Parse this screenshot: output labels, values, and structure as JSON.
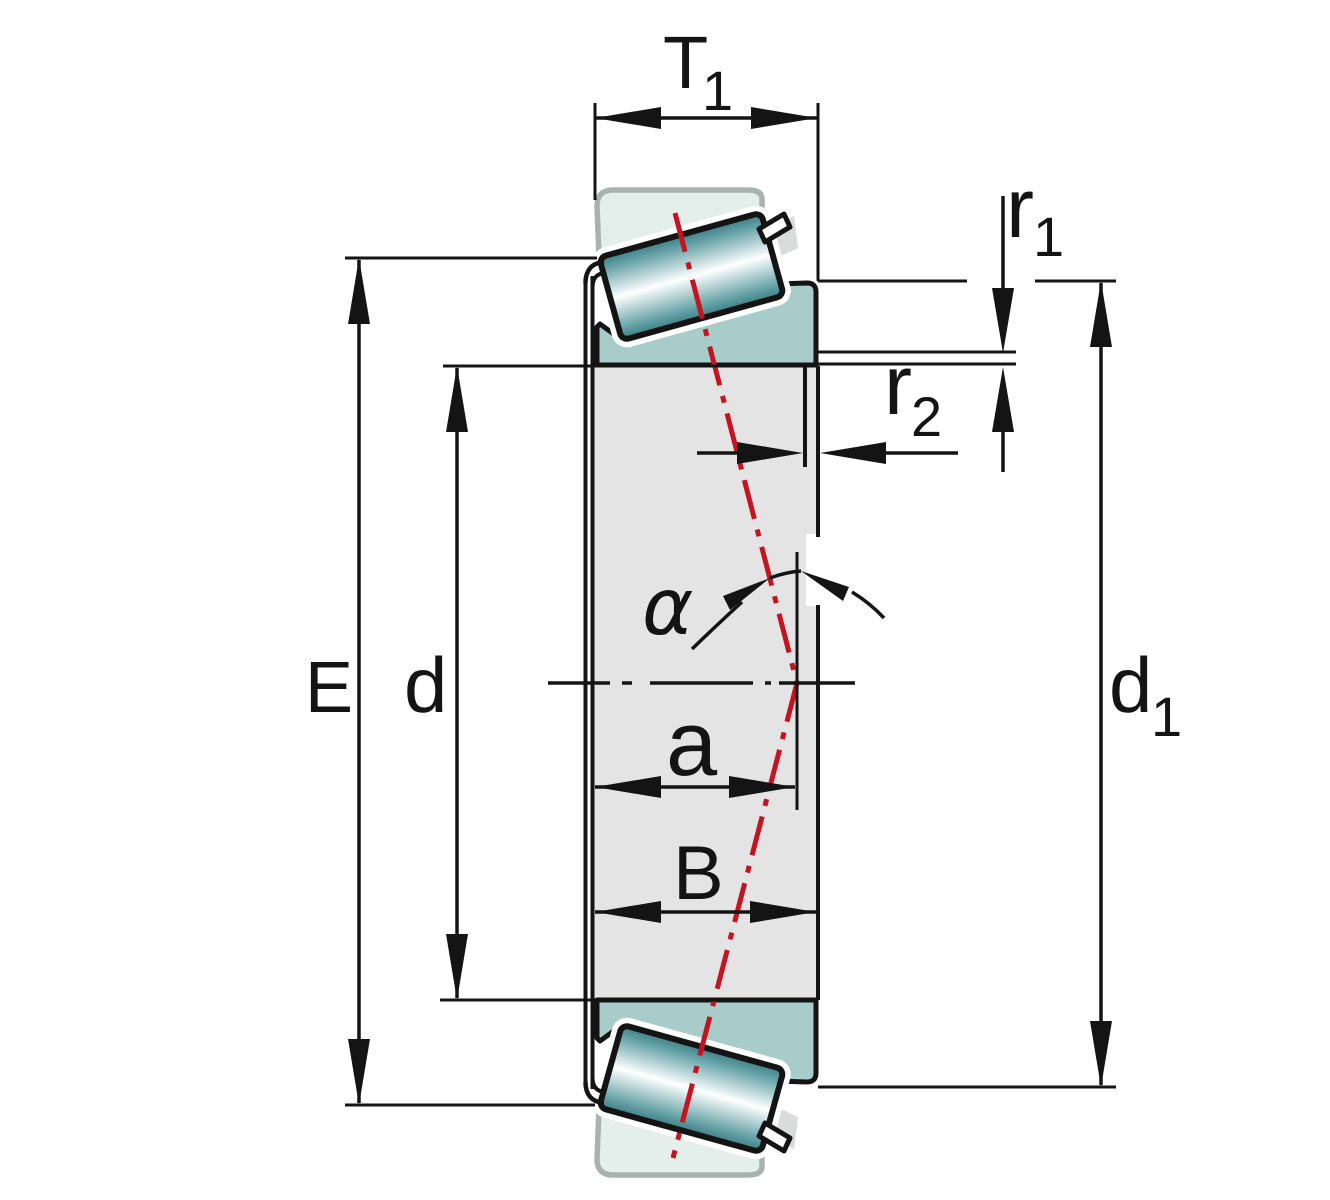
{
  "diagram": {
    "kind": "tapered-roller-bearing-dimension-drawing",
    "labels": {
      "t1": {
        "base": "T",
        "sub": "1"
      },
      "r1": {
        "base": "r",
        "sub": "1"
      },
      "r2": {
        "base": "r",
        "sub": "2"
      },
      "alpha": {
        "base": "α"
      },
      "a": {
        "base": "a"
      },
      "E": {
        "base": "E"
      },
      "d": {
        "base": "d"
      },
      "B": {
        "base": "B"
      },
      "d1": {
        "base": "d",
        "sub": "1"
      }
    },
    "colors": {
      "outline_black": "#141414",
      "outer_ring_fill": "#e4efec",
      "outer_ring_border": "#a8b2ae",
      "inner_ring_fill": "#a7ccc9",
      "roller_edge_teal": "#3d7d85",
      "roller_mid_teal": "#62a0a5",
      "roller_highlight": "#feffff",
      "bore_fill": "#e4e4e4",
      "cage_slot_gray": "#d9dcda",
      "pressure_line_red": "#c41420",
      "background": "#ffffff"
    }
  }
}
